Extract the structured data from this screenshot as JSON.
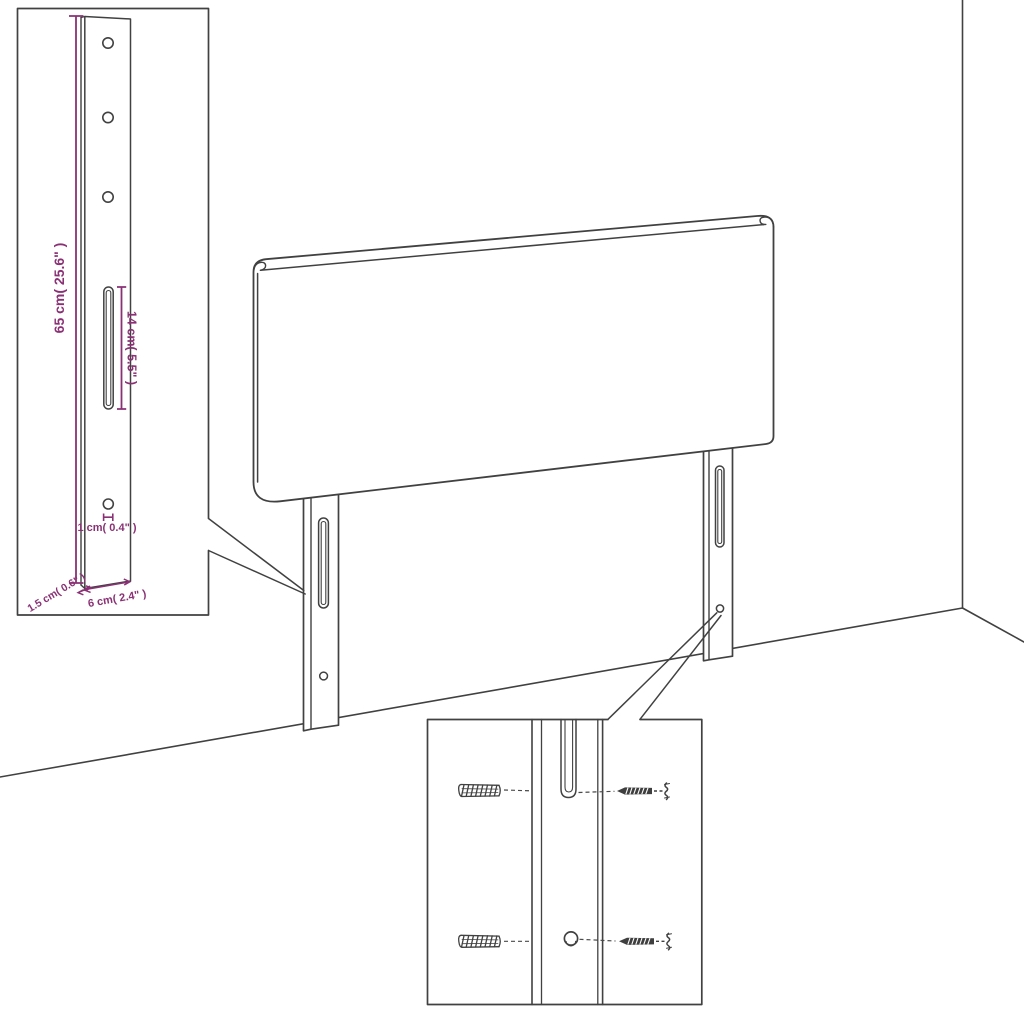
{
  "drawing": {
    "title": "Headboard technical line drawing",
    "background_color": "#ffffff",
    "line_color": "#414141",
    "dimension_color": "#8a3175"
  },
  "dimensions": {
    "leg_height": "65 cm( 25.6\" )",
    "slot_length": "14 cm( 5.5\" )",
    "hole_diameter": "1 cm( 0.4\" )",
    "leg_thickness": "1.5 cm( 0.6\" )",
    "leg_width": "6 cm( 2.4\" )"
  },
  "scene": {
    "main_subject": "headboard panel with two slotted mounting legs standing at a wall corner",
    "insets": [
      {
        "name": "leg-detail",
        "content": "full mounting leg with three screw holes, adjustment slot, lower hole and dimension callouts"
      },
      {
        "name": "mounting-detail",
        "content": "close-up of leg slot and hole with wall plugs and screws"
      }
    ],
    "hardware": {
      "wall_plugs": 2,
      "screws": 2
    }
  }
}
